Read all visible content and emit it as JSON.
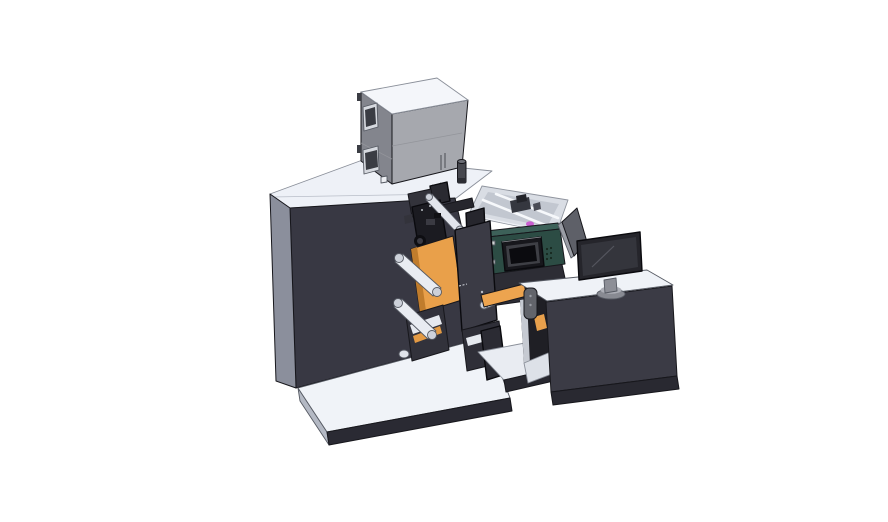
{
  "scene": {
    "description": "3D CAD isometric render of an industrial roll-fed label printing machine: dark main cabinet with feeder box on top, unwind rollers with orange web panels, print-head assembly, teal operator control box with small display, parts tray, and an operator desk console with a monitor on the right",
    "background": "#ffffff"
  },
  "parts": {
    "machine_cabinet": "main machine cabinet",
    "feeder_box": "gray feeder box on top",
    "exhaust_cylinder": "small cylinder stack",
    "print_head": "print head assembly",
    "web_panels": "orange media web panels",
    "rollers": "white guide rollers",
    "control_box": "teal operator control box with display",
    "parts_tray": "open parts tray with rails",
    "base_platform": "floor base platform",
    "console_desk": "operator desk console",
    "monitor": "desktop monitor",
    "back_panel": "rear display panel",
    "handle": "gray release handle"
  },
  "colors": {
    "bg": "#ffffff",
    "machine_top": "#eef1f7",
    "machine_front": "#383843",
    "machine_chamfer": "#8b8f9c",
    "base_top": "#f0f3f8",
    "base_side": "#b4b9c4",
    "base_front": "#2a2a33",
    "box_top": "#f4f6fa",
    "box_front": "#a6a8ae",
    "box_side": "#83858d",
    "window_frame": "#d6d9df",
    "window_glass": "#3a3c43",
    "hinge_dark": "#3b3d44",
    "square_tag": "#eceef2",
    "cyl_body": "#46474e",
    "cyl_top": "#6d6f77",
    "cyl_band": "#2c2d33",
    "tray_wall": "#d8dce3",
    "tray_floor": "#c2c7d0",
    "tray_part_dark": "#35373f",
    "tray_part_darker": "#23242a",
    "tray_part_mid": "#4a4c55",
    "magenta_part": "#c95fd0",
    "side_box_dark": "#26262d",
    "under_dark": "#2d2d35",
    "teal_top": "#3d6159",
    "teal_front": "#2c4c44",
    "teal_side": "#1d332e",
    "display_outer": "#17171c",
    "display_bezel": "#3e3f45",
    "display_screen": "#0b0b0f",
    "vent_dot": "#16281f",
    "bolt_light": "#cdd4d2",
    "head_top": "#2a2a31",
    "head_back": "#33333b",
    "head_main": "#1b1b21",
    "head_arm": "#26262d",
    "head_bit": "#3a3a42",
    "head_bit_dark": "#101014",
    "hub_dark": "#0e0e12",
    "hub_inner": "#3c3c44",
    "roller_white": "#e9ecf2",
    "roller_lightbar": "#e2e5ec",
    "roller_cap": "#cdd1da",
    "roller_cap2": "#dfe3ea",
    "orange_web": "#e9a04a",
    "orange_shade": "#c07c2c",
    "orange_strip": "#eda44f",
    "orange_small": "#e8a04c",
    "plate_dark": "#3b3b45",
    "plate_dot": "#b9bdc5",
    "bracket_dark": "#32323b",
    "bracket_dark2": "#2f2f38",
    "slant_white": "#e6e9ef",
    "slant_orange": "#e39a44",
    "support_dark": "#2b2b33",
    "platform_top": "#e9ecf2",
    "platform_front": "#282830",
    "recess_dark": "#1f1f25",
    "recess_wall": "#c6cad2",
    "recess_floor": "#dde1e8",
    "console_front": "#3b3b45",
    "console_plinth": "#292931",
    "console_top": "#eff2f7",
    "handle_gray": "#62646b",
    "handle_dot": "#9a9da4",
    "panel_back": "#5e6068",
    "panel_edge": "#9a9da5",
    "monitor_frame": "#25252b",
    "monitor_screen": "#34353c",
    "monitor_neck": "#8d8f97",
    "monitor_base": "#888a92",
    "monitor_base_top": "#adafb7"
  }
}
